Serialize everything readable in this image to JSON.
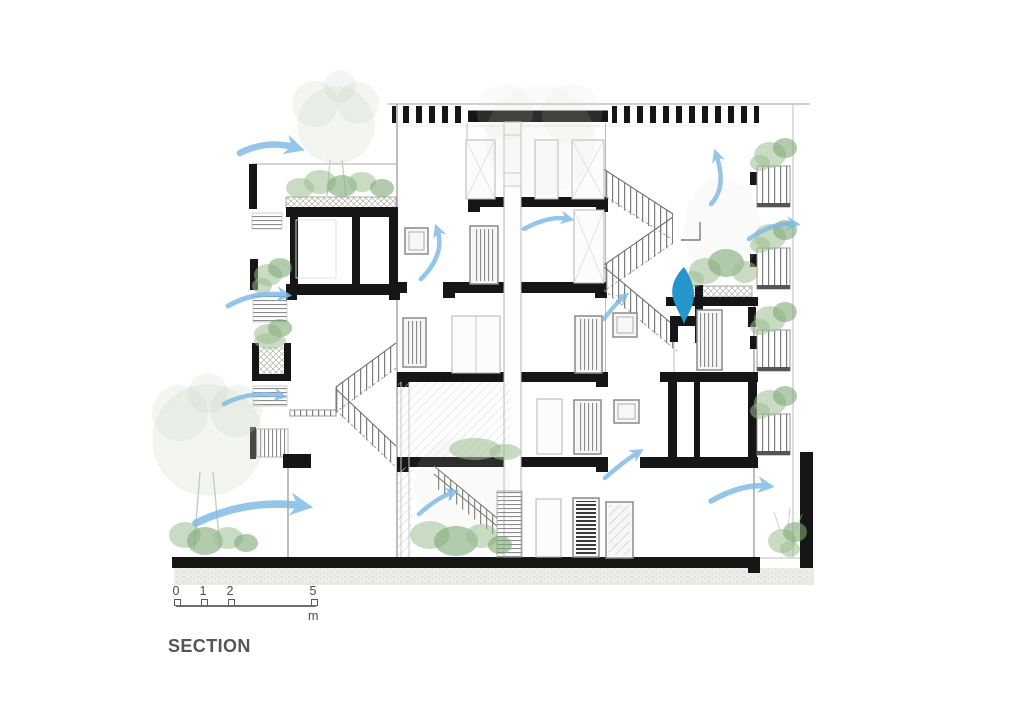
{
  "drawing_title": {
    "label": "SECTION"
  },
  "scale_bar": {
    "tick_labels": [
      "0",
      "1",
      "2",
      "5"
    ],
    "unit_label": "m"
  },
  "palette": {
    "wall_black": "#161616",
    "line_gray": "#9a9a9a",
    "airflow_blue": "#7db9e6",
    "leaf_blue": "#2496cb",
    "plant_green": "#9cbe92",
    "plant_green_faint": "#ccdac6",
    "ground_stipple": "#d9d8d0",
    "title_gray": "#54555a"
  },
  "annotations": {
    "type": "architectural cross-section with natural-ventilation airflow arrows",
    "airflow_arrow_count": 12,
    "levels_visible": 5
  }
}
